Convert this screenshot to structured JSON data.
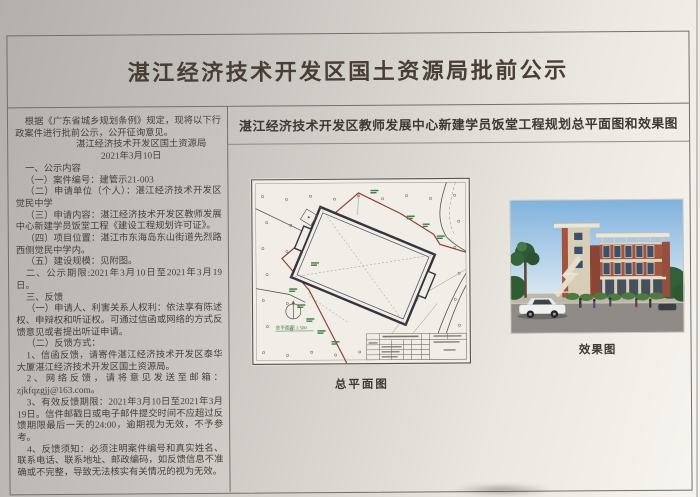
{
  "document": {
    "main_title": "湛江经济技术开发区国土资源局批前公示",
    "left_column": {
      "intro": "根据《广东省城乡规划条例》规定，现将以下行政案件进行批前公示，公开征询意见。",
      "issuer": "湛江经济技术开发区国土资源局",
      "issue_date": "2021年3月10日",
      "paragraphs": [
        "一、公示内容",
        "（一）案件编号：建管示21-003",
        "（二）申请单位（个人）：湛江经济技术开发区觉民中学",
        "（三）申请内容：湛江经济技术开发区教师发展中心新建学员饭堂工程《建设工程规划许可证》。",
        "（四）项目位置：湛江市东海岛东山街道先烈路西侧觉民中学内。",
        "（五）建设规模：见附图。",
        "二、公示期限:2021年3月10日至2021年3月19日。",
        "三、反馈",
        "（一）申请人、利害关系人权利：依法享有陈述权、申辩权和听证权。可通过信函或网络的方式反馈意见或者提出听证申请。",
        "（二）反馈方式：",
        "1、信函反馈，请寄件湛江经济技术开发区泰华大厦湛江经济技术开发区国土资源局。",
        "2、网络反馈，请将意见发送至邮箱：zjkfqzgjj@163.com。",
        "3、有效反馈期限：2021年3月10日至2021年3月19日。信件邮戳日或电子邮件提交时间不应超过反馈期限最后一天的24:00，逾期视为无效，不予参考。",
        "4、反馈须知：必须注明案件编号和真实姓名、联系电话、联系地址、邮政编码，如反馈信息不准确或不完整，导致无法核实有关情况的视为无效。"
      ]
    },
    "right_panel": {
      "title": "湛江经济技术开发区教师发展中心新建学员饭堂工程规划总平面图和效果图",
      "site_plan": {
        "caption": "总平面图",
        "scale_label": "总平面图 1:500"
      },
      "rendering": {
        "caption": "效果图"
      }
    }
  },
  "colors": {
    "paper_light": "#f7f5ef",
    "paper_dark": "#b3b0ab",
    "frame_line": "#73706a",
    "title_text": "#483e36",
    "body_text": "#46413b",
    "boundary_red": "#943a3b",
    "plan_green": "#3f7d46",
    "brick": "#a2543e",
    "sky_blue": "#7fb2dd"
  }
}
